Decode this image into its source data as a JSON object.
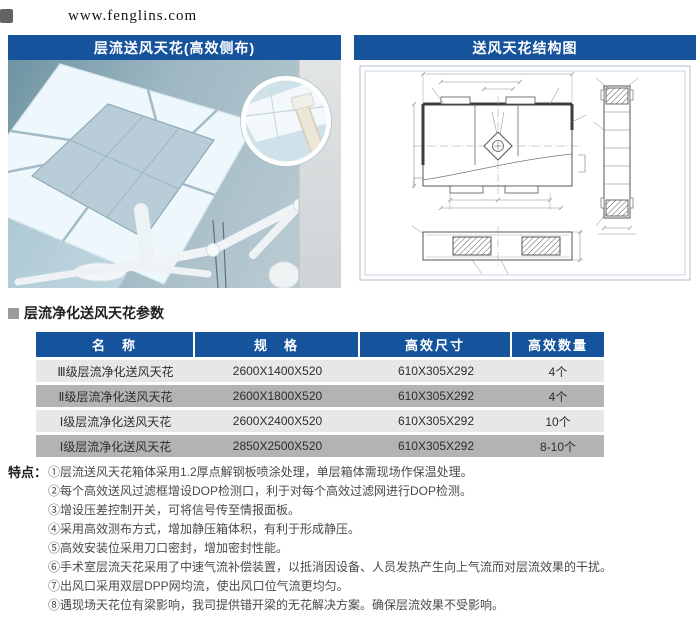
{
  "page": {
    "watermark": "www.fenglins.com"
  },
  "panels": {
    "photo": {
      "title": "层流送风天花(高效侧布)"
    },
    "diagram": {
      "title": "送风天花结构图"
    }
  },
  "params": {
    "section_title": "层流净化送风天花参数",
    "table": {
      "headers": [
        "名　称",
        "规　格",
        "高效尺寸",
        "高效数量"
      ],
      "rows": [
        [
          "Ⅲ级层流净化送风天花",
          "2600X1400X520",
          "610X305X292",
          "4个"
        ],
        [
          "Ⅱ级层流净化送风天花",
          "2600X1800X520",
          "610X305X292",
          "4个"
        ],
        [
          "Ⅰ级层流净化送风天花",
          "2600X2400X520",
          "610X305X292",
          "10个"
        ],
        [
          "Ⅰ级层流净化送风天花",
          "2850X2500X520",
          "610X305X292",
          "8-10个"
        ]
      ]
    }
  },
  "features": {
    "label": "特点：",
    "items": [
      "①层流送风天花箱体采用1.2厚点解钢板喷涂处理，单层箱体需现场作保温处理。",
      "②每个高效送风过滤框增设DOP检测口，利于对每个高效过滤网进行DOP检测。",
      "③增设压差控制开关，可将信号传至情报面板。",
      "④采用高效测布方式，增加静压箱体积，有利于形成静压。",
      "⑤高效安装位采用刀口密封，增加密封性能。",
      "⑥手术室层流天花采用了中速气流补偿装置，以抵消因设备、人员发热产生向上气流而对层流效果的干扰。",
      "⑦出风口采用双层DPP网均流，使出风口位气流更均匀。",
      "⑧遇现场天花位有梁影响，我司提供错开梁的无花解决方案。确保层流效果不受影响。"
    ]
  },
  "colors": {
    "header_blue": "#15539c",
    "row_light": "#e7e7e7",
    "row_dark": "#b3b3b3",
    "photo_sky": "#9db7c2",
    "panel_light": "#f2f8fb"
  }
}
